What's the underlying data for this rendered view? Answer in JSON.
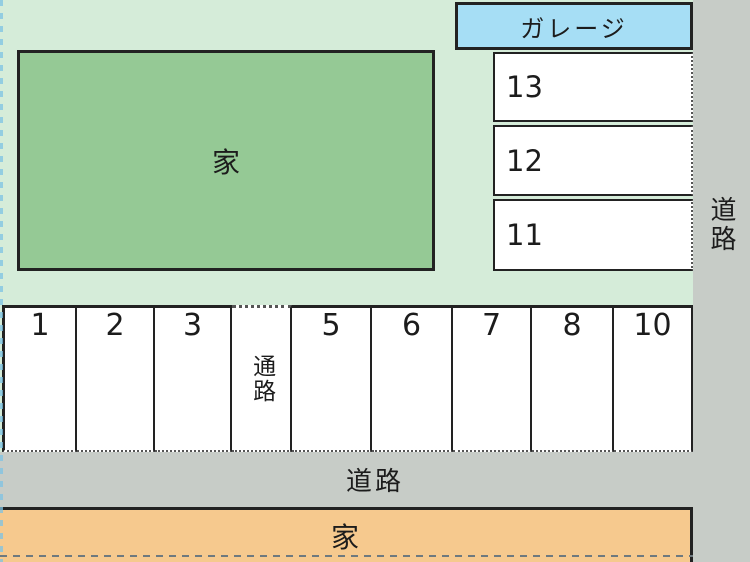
{
  "colors": {
    "bg": "#d5ecd9",
    "road": "#c7ccc7",
    "house-top": "#95c995",
    "garage": "#a6def5",
    "house-bottom": "#f6c98e",
    "stall": "#ffffff",
    "border": "#222222"
  },
  "houses": {
    "top": {
      "label": "家"
    },
    "bottom": {
      "label": "家"
    }
  },
  "garage": {
    "label": "ガレージ",
    "stalls": [
      {
        "label": "13"
      },
      {
        "label": "12"
      },
      {
        "label": "11"
      }
    ]
  },
  "roads": {
    "right_label": "道路",
    "bottom_label": "道路"
  },
  "parking_row": {
    "stalls": [
      {
        "label": "1",
        "kind": "stall"
      },
      {
        "label": "2",
        "kind": "stall"
      },
      {
        "label": "3",
        "kind": "stall"
      },
      {
        "label": "通路",
        "kind": "aisle"
      },
      {
        "label": "5",
        "kind": "stall"
      },
      {
        "label": "6",
        "kind": "stall"
      },
      {
        "label": "7",
        "kind": "stall"
      },
      {
        "label": "8",
        "kind": "stall"
      },
      {
        "label": "10",
        "kind": "stall"
      }
    ]
  }
}
